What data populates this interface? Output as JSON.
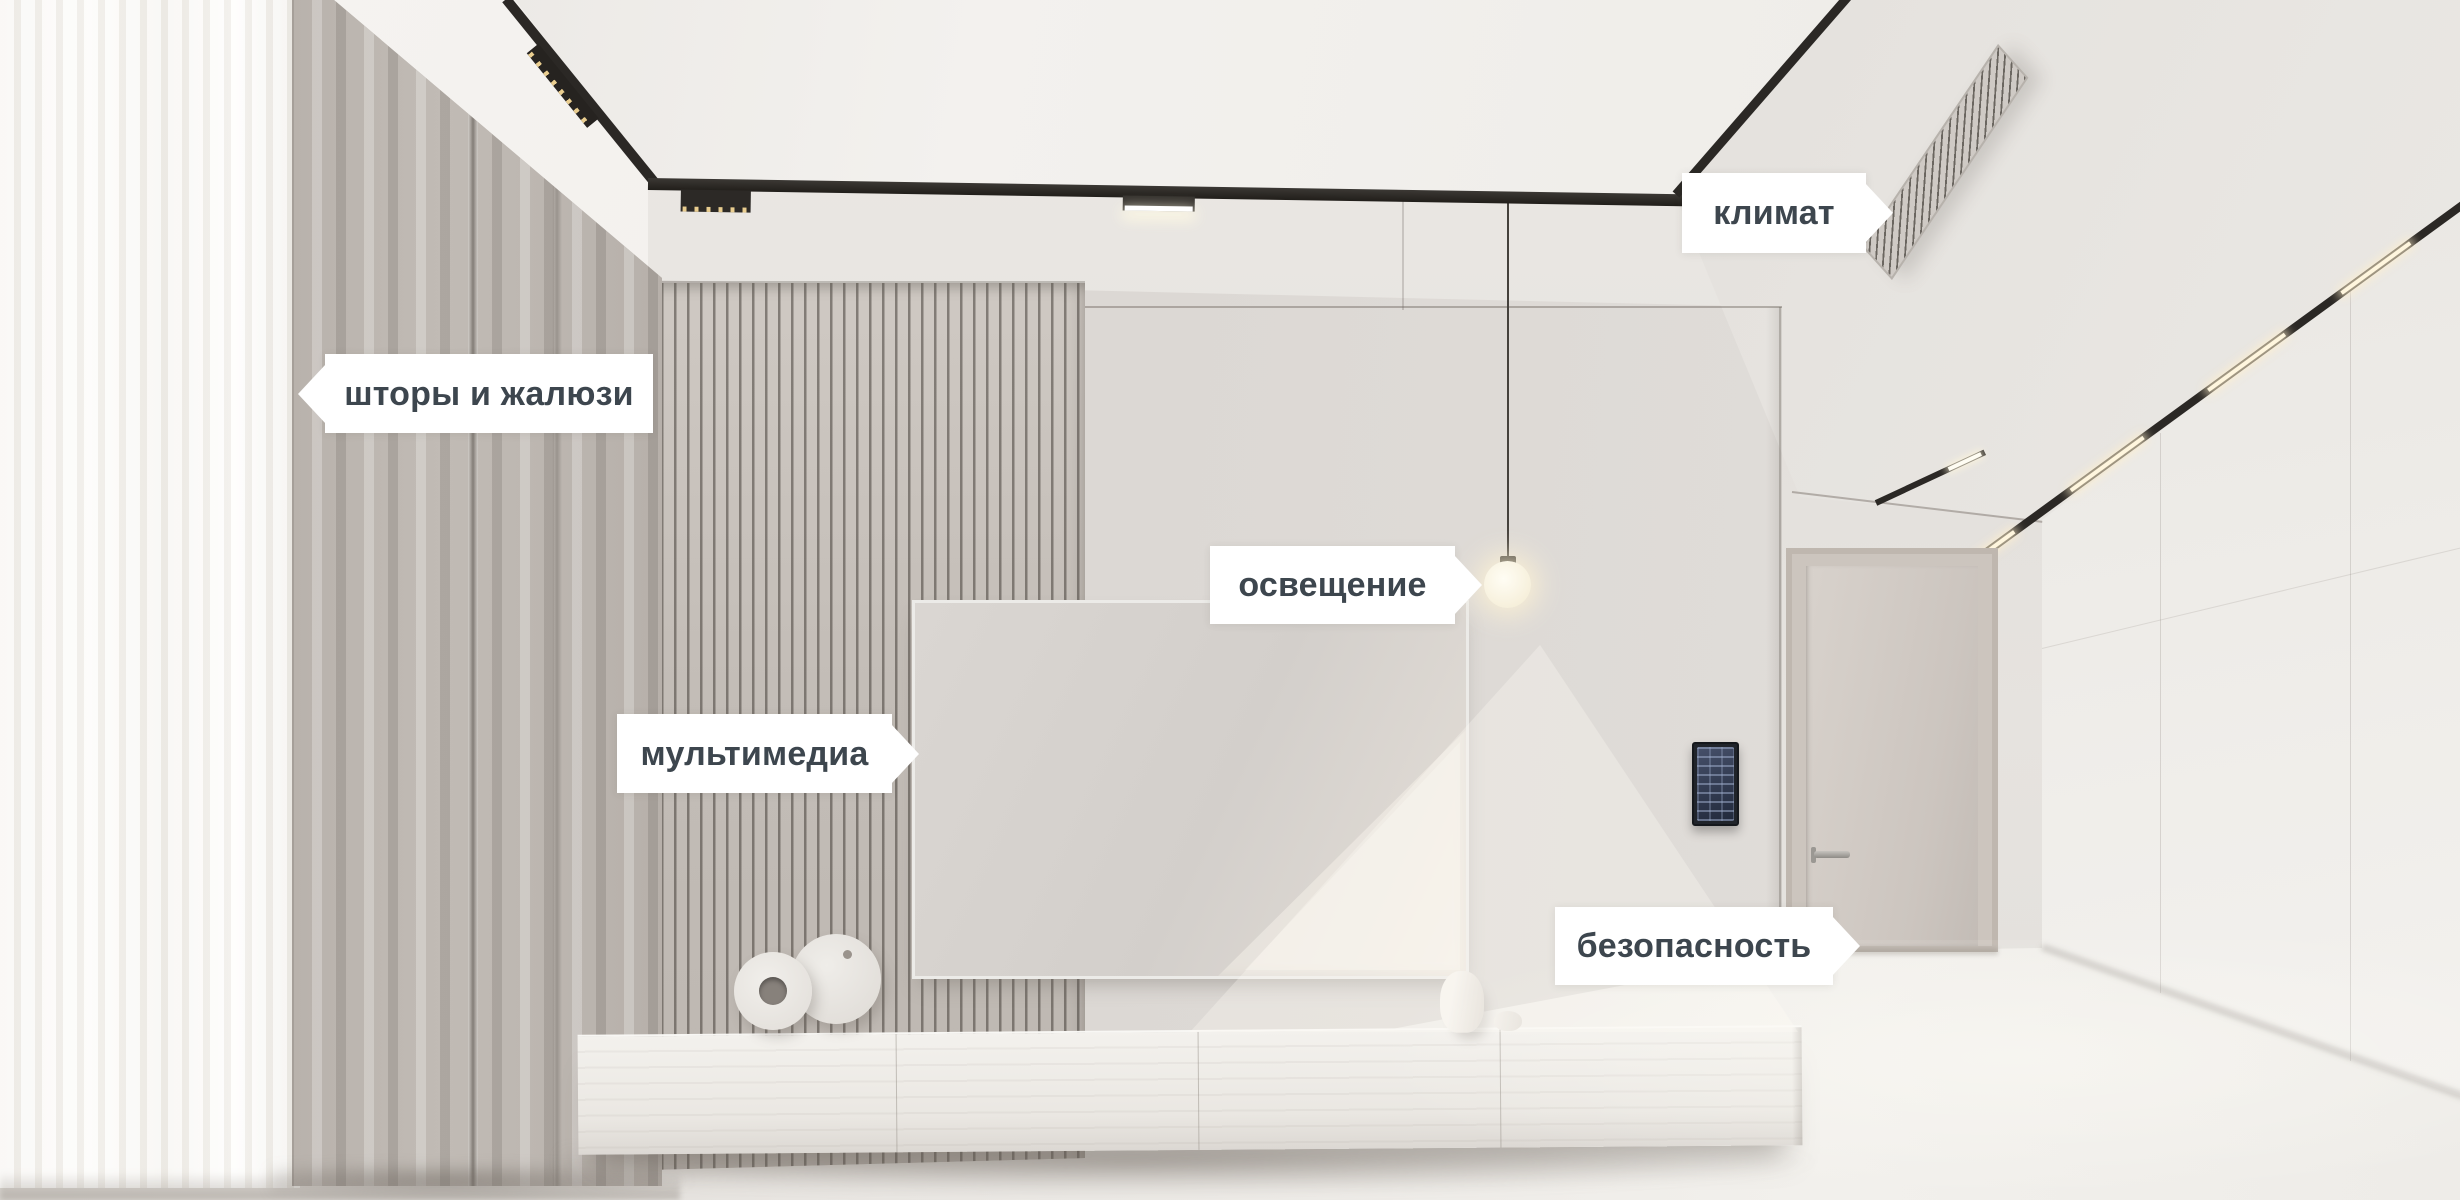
{
  "scene": {
    "description": "Photorealistic smart-home living room render with feature callout tags",
    "colors": {
      "label_background": "#ffffff",
      "label_text": "#3d464e",
      "track_black": "#2b2825",
      "warm_glow": "#fff3d8",
      "wall_gray": "#dcd8d4"
    }
  },
  "callouts": [
    {
      "id": "curtains",
      "label": "шторы и жалюзи",
      "arrow": "left"
    },
    {
      "id": "climate",
      "label": "климат",
      "arrow": "right"
    },
    {
      "id": "lighting",
      "label": "освещение",
      "arrow": "right"
    },
    {
      "id": "multimedia",
      "label": "мультимедиа",
      "arrow": "right"
    },
    {
      "id": "security",
      "label": "безопасность",
      "arrow": "right"
    }
  ]
}
